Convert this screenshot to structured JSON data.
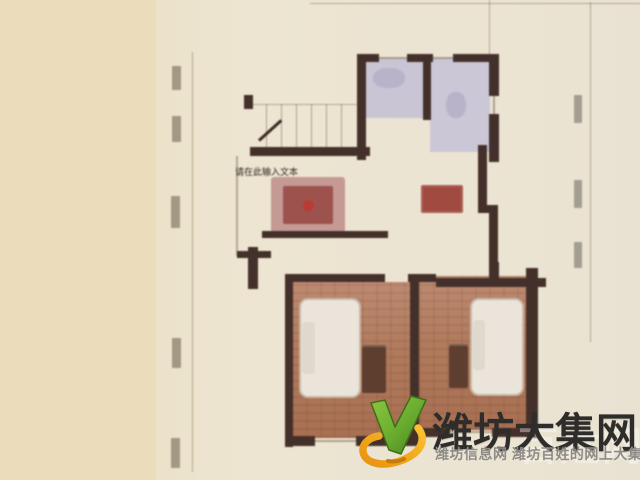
{
  "canvas": {
    "width": 640,
    "height": 480
  },
  "floorplan": {
    "editor_placeholder": "请在此输入文本",
    "wall_color": "#44302a",
    "sheet_color": "#ede5d1",
    "background_color": "#ebdcbc",
    "bathroom_floor_color": "#c9c5d5",
    "bedroom_floor_color": "#b07a5c",
    "rug_color": "#9d524e"
  },
  "watermark": {
    "site_name": "潍坊大集网",
    "tagline": "潍坊信息网 潍坊百姓的网上大集",
    "ghost_text": "百姓网",
    "colors": {
      "logo_green": "#6cae31",
      "logo_green_dark": "#4c7d1f",
      "logo_orange": "#f2a31d",
      "title": "#2f2d2b",
      "tagline": "#8e8b86"
    }
  }
}
